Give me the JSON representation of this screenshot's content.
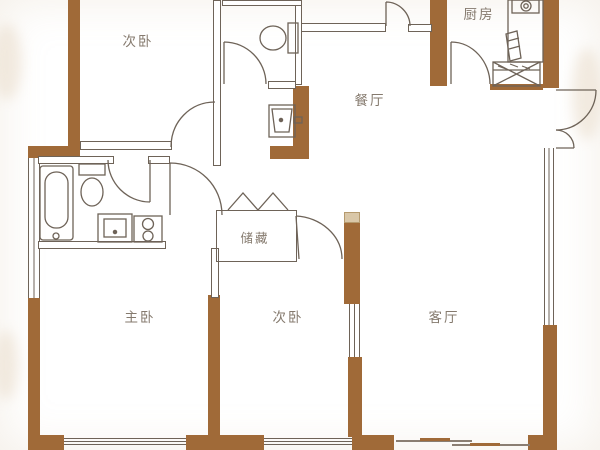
{
  "plan_title": "apartment-floor-plan",
  "rooms": [
    {
      "id": "bedroom-top-left",
      "label": "次卧"
    },
    {
      "id": "kitchen",
      "label": "厨房"
    },
    {
      "id": "dining-room",
      "label": "餐厅"
    },
    {
      "id": "storage",
      "label": "储藏"
    },
    {
      "id": "master-bedroom",
      "label": "主卧"
    },
    {
      "id": "bedroom-bottom",
      "label": "次卧"
    },
    {
      "id": "living-room",
      "label": "客厅"
    }
  ],
  "colors": {
    "wall_brown": "#a06a38",
    "line_dark": "#6e6358",
    "label_gray": "#857a6e",
    "wall_cap_tan": "#d9c7a8",
    "background": "#ffffff"
  },
  "fixtures": [
    "bathtub",
    "toilet",
    "vanity-sink",
    "washing-machine",
    "toilet-2",
    "wash-basin",
    "kitchen-stove",
    "kitchen-counter",
    "drying-rack",
    "tall-cabinet",
    "bifold-closet-doors"
  ],
  "doors": [
    "bedroom-top-left-door",
    "bathroom-door",
    "master-bedroom-door",
    "top-bathroom-door",
    "kitchen-door",
    "storage-side-door",
    "entry-double-door",
    "north-door",
    "balcony-sliding-door"
  ]
}
